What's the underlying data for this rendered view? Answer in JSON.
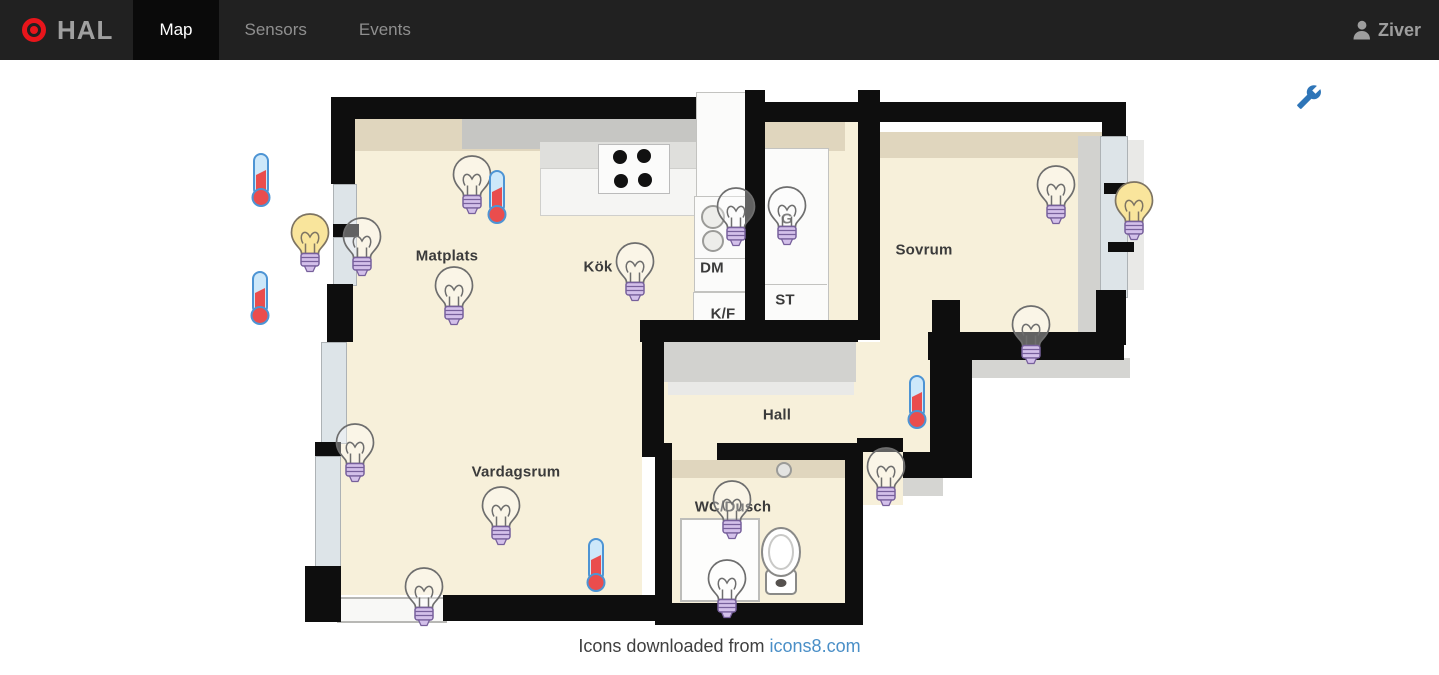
{
  "navbar": {
    "brand": "HAL",
    "logo_icon": "target-icon",
    "tabs": [
      {
        "label": "Map",
        "active": true
      },
      {
        "label": "Sensors",
        "active": false
      },
      {
        "label": "Events",
        "active": false
      }
    ],
    "user": "Ziver",
    "user_icon": "person-icon"
  },
  "toolbar": {
    "settings_icon": "wrench-icon"
  },
  "floorplan": {
    "labels": [
      {
        "text": "Matplats",
        "x": 447,
        "y": 256,
        "kind": "room"
      },
      {
        "text": "Kök",
        "x": 598,
        "y": 267,
        "kind": "room"
      },
      {
        "text": "Sovrum",
        "x": 924,
        "y": 250,
        "kind": "room"
      },
      {
        "text": "Hall",
        "x": 777,
        "y": 415,
        "kind": "room"
      },
      {
        "text": "Vardagsrum",
        "x": 516,
        "y": 472,
        "kind": "room"
      },
      {
        "text": "WC/Dusch",
        "x": 733,
        "y": 507,
        "kind": "room"
      },
      {
        "text": "DM",
        "x": 712,
        "y": 268,
        "kind": "fixture"
      },
      {
        "text": "K/F",
        "x": 723,
        "y": 314,
        "kind": "fixture"
      },
      {
        "text": "ST",
        "x": 785,
        "y": 300,
        "kind": "fixture"
      },
      {
        "text": "G",
        "x": 787,
        "y": 219,
        "kind": "fixture"
      }
    ],
    "sensors": [
      {
        "type": "bulb",
        "state": "on",
        "x": 310,
        "y": 242
      },
      {
        "type": "bulb",
        "state": "off",
        "x": 362,
        "y": 246
      },
      {
        "type": "bulb",
        "state": "off",
        "x": 472,
        "y": 184
      },
      {
        "type": "bulb",
        "state": "off",
        "x": 454,
        "y": 295
      },
      {
        "type": "bulb",
        "state": "off",
        "x": 635,
        "y": 271
      },
      {
        "type": "bulb",
        "state": "off",
        "x": 736,
        "y": 216
      },
      {
        "type": "bulb",
        "state": "off",
        "x": 787,
        "y": 215
      },
      {
        "type": "bulb",
        "state": "off",
        "x": 1056,
        "y": 194
      },
      {
        "type": "bulb",
        "state": "on",
        "x": 1134,
        "y": 210
      },
      {
        "type": "bulb",
        "state": "off",
        "x": 1031,
        "y": 334
      },
      {
        "type": "bulb",
        "state": "off",
        "x": 886,
        "y": 476
      },
      {
        "type": "bulb",
        "state": "off",
        "x": 732,
        "y": 509
      },
      {
        "type": "bulb",
        "state": "off",
        "x": 727,
        "y": 588
      },
      {
        "type": "bulb",
        "state": "off",
        "x": 355,
        "y": 452
      },
      {
        "type": "bulb",
        "state": "off",
        "x": 501,
        "y": 515
      },
      {
        "type": "bulb",
        "state": "off",
        "x": 424,
        "y": 596
      },
      {
        "type": "thermometer",
        "x": 261,
        "y": 180
      },
      {
        "type": "thermometer",
        "x": 260,
        "y": 298
      },
      {
        "type": "thermometer",
        "x": 497,
        "y": 197
      },
      {
        "type": "thermometer",
        "x": 917,
        "y": 402
      },
      {
        "type": "thermometer",
        "x": 596,
        "y": 565
      }
    ]
  },
  "footer": {
    "text": "Icons downloaded from",
    "link": "icons8.com"
  },
  "colors": {
    "navbar_bg": "#212121",
    "active_tab_bg": "#0a0a0a",
    "logo_red": "#e8151b",
    "accent_blue": "#2e75b8",
    "link_blue": "#4a8fc7",
    "bulb_on_fill": "#f9e59c",
    "bulb_base_purple": "#d3c0ea",
    "thermometer_red": "#ea4d4d",
    "thermometer_blue": "#4d94d4",
    "floor_beige": "#f7f0da",
    "wall_black": "#0e0e0e"
  }
}
